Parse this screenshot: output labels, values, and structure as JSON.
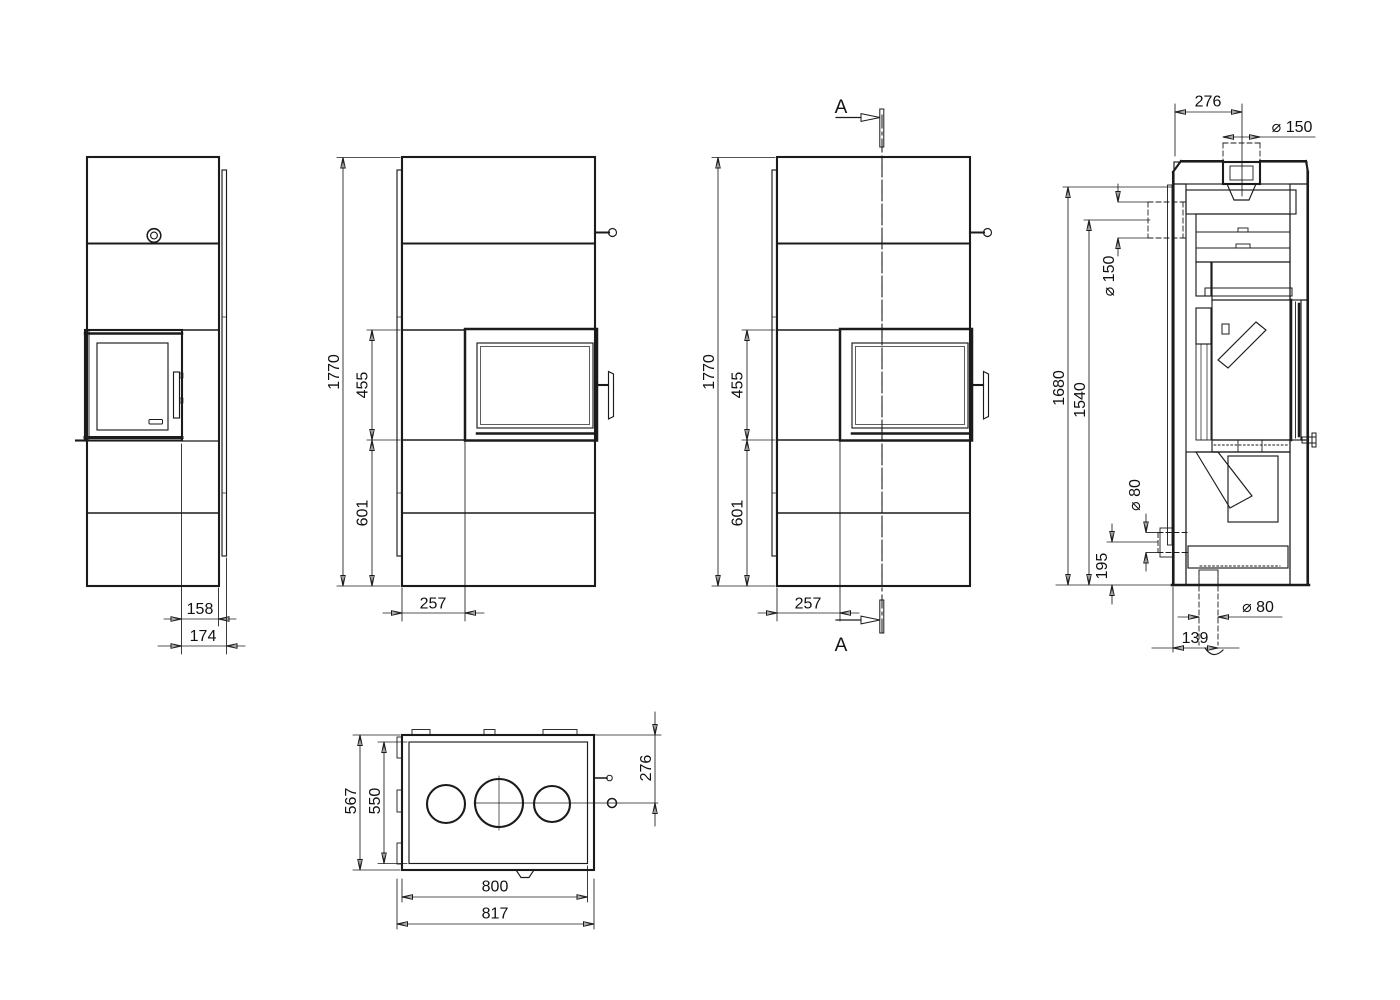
{
  "views": {
    "side": {
      "depth_front_to_rear": "158",
      "depth_total": "174"
    },
    "front": {
      "height_total": "1770",
      "door_height": "455",
      "base_height": "601",
      "door_offset": "257"
    },
    "front_section": {
      "cut_label": "A"
    },
    "cross_section": {
      "top_depth": "276",
      "flue_top_diameter": "⌀ 150",
      "flue_rear_diameter": "⌀ 150",
      "flue_top_height": "1680",
      "flue_rear_height": "1540",
      "air_inlet_rear_diameter": "⌀ 80",
      "air_inlet_rear_height": "195",
      "air_inlet_bottom_diameter": "⌀ 80",
      "air_inlet_bottom_offset": "139"
    },
    "plan": {
      "depth_total": "567",
      "depth_body": "550",
      "rear_to_axis": "276",
      "width_body": "800",
      "width_total": "817"
    }
  }
}
